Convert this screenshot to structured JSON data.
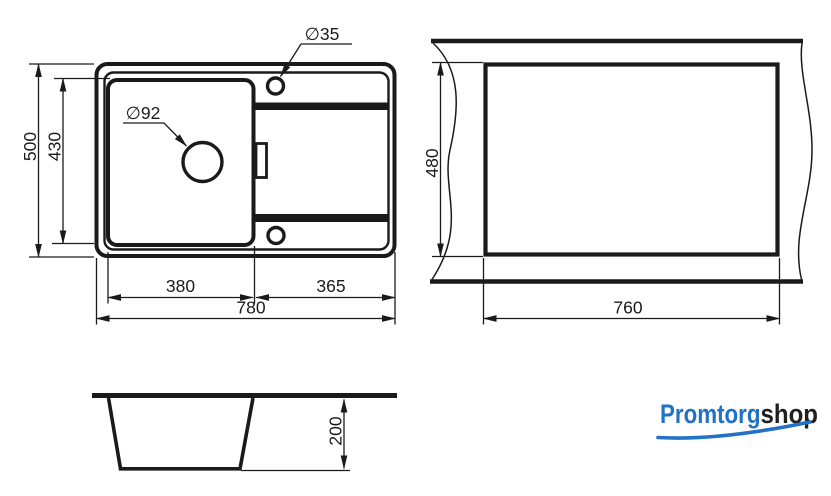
{
  "page": {
    "background": "#ffffff"
  },
  "colors": {
    "line": "#1a1a1a",
    "logo_blue": "#2171c5",
    "logo_dark": "#1f1f1d"
  },
  "top_view": {
    "overall_depth": "500",
    "bowl_depth": "430",
    "bowl_width": "380",
    "wing_width": "365",
    "overall_width": "780",
    "drain_hole_diameter": "∅92",
    "tap_hole_diameter": "∅35"
  },
  "cutout_view": {
    "cutout_depth": "480",
    "cutout_width": "760"
  },
  "section_view": {
    "bowl_depth": "200"
  },
  "logo": {
    "text_primary": "Promtorg",
    "text_secondary": "shop"
  }
}
